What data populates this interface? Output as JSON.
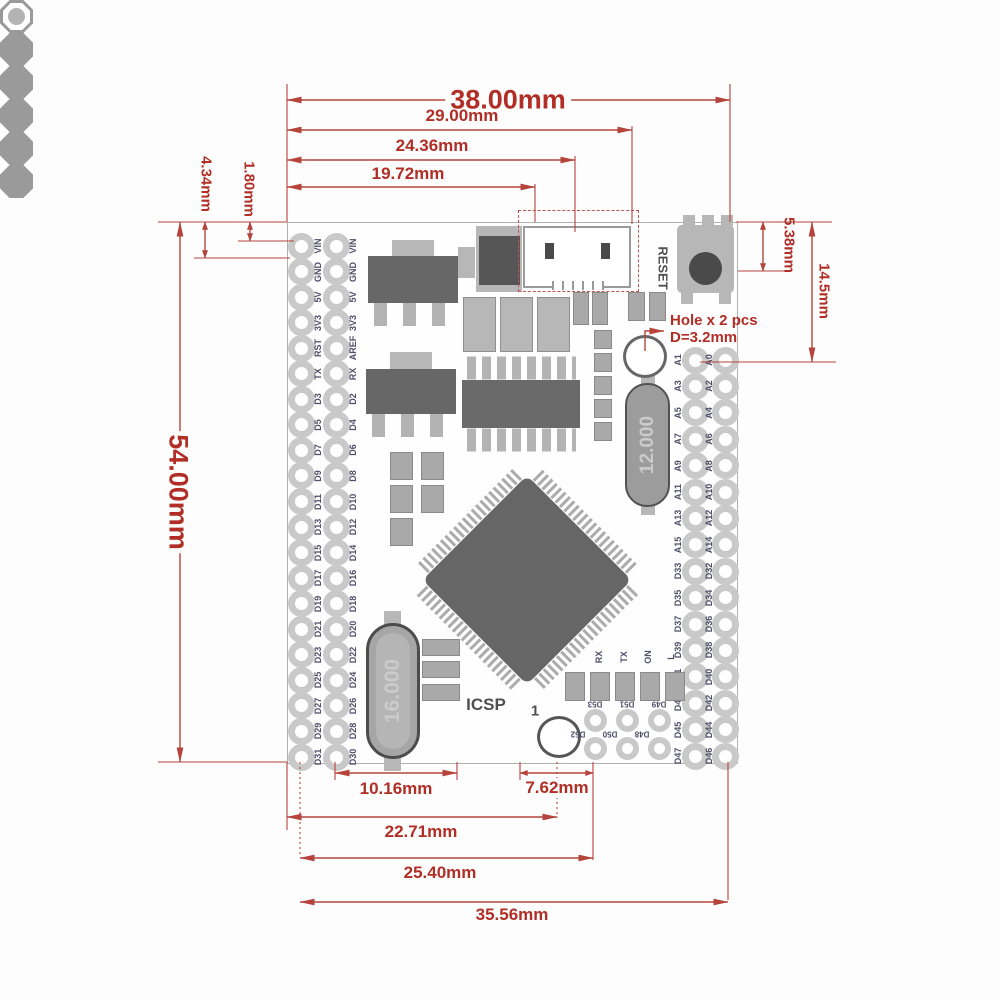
{
  "dims": {
    "d38": "38.00mm",
    "d29": "29.00mm",
    "d24_36": "24.36mm",
    "d19_72": "19.72mm",
    "d54": "54.00mm",
    "d4_34": "4.34mm",
    "d1_80": "1.80mm",
    "d5_38": "5.38mm",
    "d14_5": "14.5mm",
    "d10_16": "10.16mm",
    "d7_62": "7.62mm",
    "d22_71": "22.71mm",
    "d25_40": "25.40mm",
    "d35_56": "35.56mm"
  },
  "board": {
    "reset_label": "RESET",
    "icsp_label": "ICSP",
    "icsp_pin1": "1",
    "crystals": [
      "12.000",
      "16.000"
    ],
    "leds": [
      "RX",
      "TX",
      "ON",
      "L"
    ],
    "hole_note": {
      "line1": "Hole x 2 pcs",
      "line2": "D=3.2mm"
    },
    "left_pins": {
      "outer": [
        "VIN",
        "GND",
        "5V",
        "3V3",
        "RST",
        "TX",
        "D3",
        "D5",
        "D7",
        "D9",
        "D11",
        "D13",
        "D15",
        "D17",
        "D19",
        "D21",
        "D23",
        "D25",
        "D27",
        "D29",
        "D31"
      ],
      "inner": [
        "VIN",
        "GND",
        "5V",
        "3V3",
        "AREF",
        "RX",
        "D2",
        "D4",
        "D6",
        "D8",
        "D10",
        "D12",
        "D14",
        "D16",
        "D18",
        "D20",
        "D22",
        "D24",
        "D26",
        "D28",
        "D30"
      ]
    },
    "right_pins": {
      "inner": [
        "A1",
        "A3",
        "A5",
        "A7",
        "A9",
        "A11",
        "A13",
        "A15",
        "D33",
        "D35",
        "D37",
        "D39",
        "D41",
        "D43",
        "D45",
        "D47"
      ],
      "outer": [
        "A0",
        "A2",
        "A4",
        "A6",
        "A8",
        "A10",
        "A12",
        "A14",
        "D32",
        "D34",
        "D36",
        "D38",
        "D40",
        "D42",
        "D44",
        "D46"
      ]
    },
    "bottom_pins": {
      "row1": [
        "D53",
        "D51",
        "D49"
      ],
      "row2": [
        "D52",
        "D50",
        "D48"
      ]
    }
  },
  "colors": {
    "dimension_red": "#b2322c",
    "component_dark": "#676767",
    "component_light": "#b7b7b7",
    "pad_ring": "#c9c9c9",
    "pin_label_ink": "#4e4e67"
  }
}
